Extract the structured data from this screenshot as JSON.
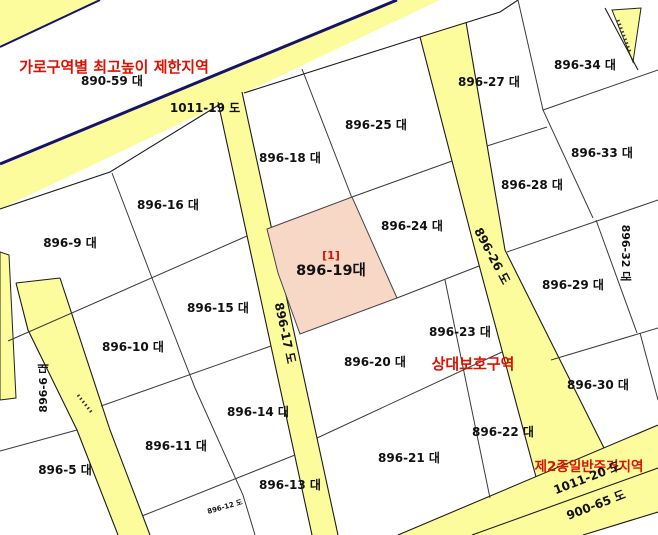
{
  "map_type": "cadastral-parcel-map",
  "colors": {
    "road_fill": "#FCFC9C",
    "highlight_fill": "#F7D8C6",
    "zone_text": "#DE1100",
    "boundary_navy": "#14146A",
    "parcel_line": "#3A3A3A"
  },
  "zones": [
    "가로구역별 최고높이 제한지역",
    "상대보호구역",
    "제2종일반주거지역"
  ],
  "highlight": {
    "marker": "[1]",
    "label": "896-19대"
  },
  "parcels": [
    "890-59 대",
    "896-9 대",
    "896-16 대",
    "896-18 대",
    "896-25 대",
    "896-27 대",
    "896-34 대",
    "896-33 대",
    "896-28 대",
    "896-24 대",
    "896-29 대",
    "896-32 대",
    "896-15 대",
    "896-10 대",
    "896-23 대",
    "896-20 대",
    "896-30 대",
    "896-6 대",
    "896-14 대",
    "896-11 대",
    "896-5 대",
    "896-21 대",
    "896-22 대",
    "896-13 대"
  ],
  "roads": [
    "1011-19 도",
    "896-17 도",
    "896-26 도",
    "1011-20 도",
    "900-65 도",
    "896-12 도"
  ]
}
